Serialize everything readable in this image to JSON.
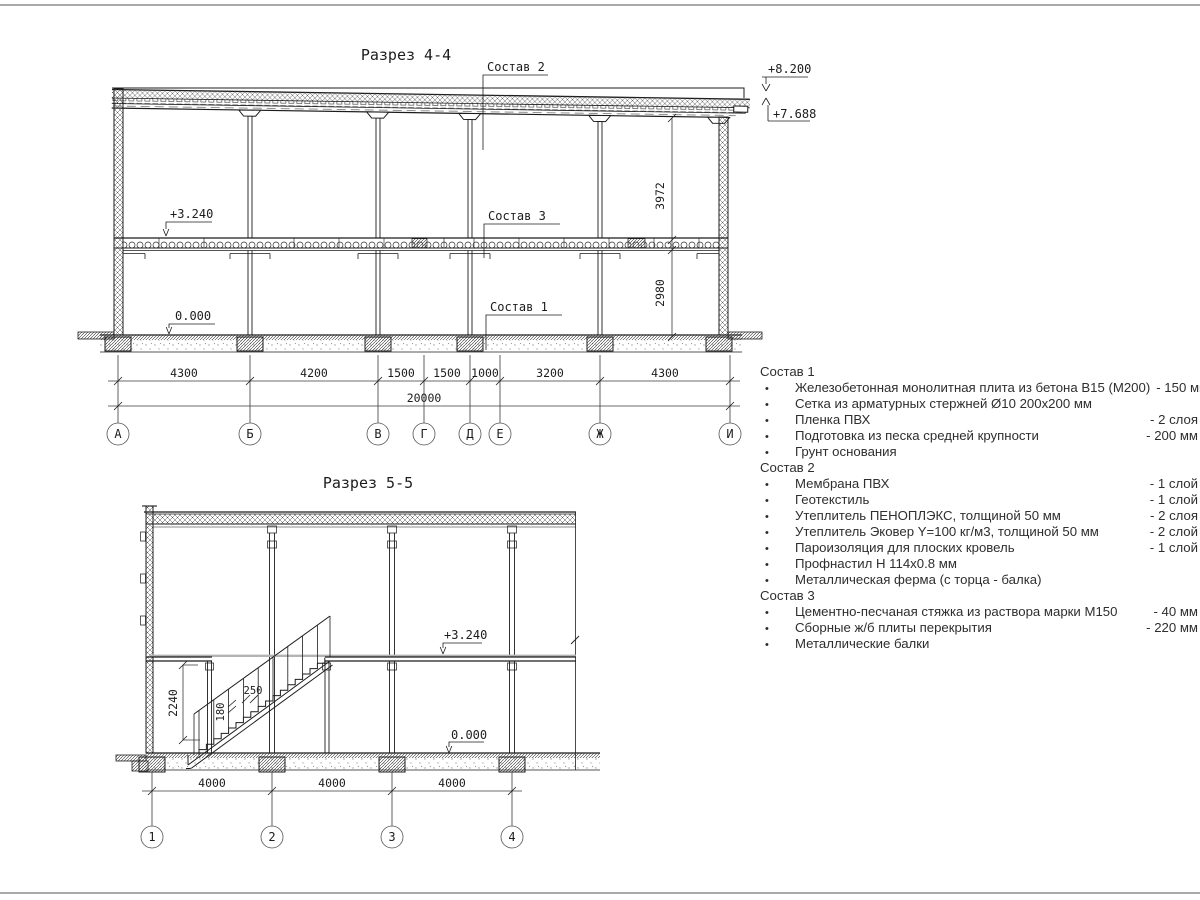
{
  "colors": {
    "ink": "#1c1c1c",
    "gray_line": "#a9a9a9",
    "soft_gray": "#8f8f8f",
    "text": "#2e2e2e"
  },
  "section44": {
    "title": "Разрез 4-4",
    "callouts": {
      "c1": "Состав 1",
      "c2": "Состав 2",
      "c3": "Состав 3"
    },
    "levels": {
      "parapet": "+8.200",
      "roof_edge": "+7.688",
      "floor": "+3.240",
      "ground": "0.000"
    },
    "dims": {
      "floor2_height": "3972",
      "floor1_height": "2980",
      "spans": [
        "4300",
        "4200",
        "1500",
        "1500",
        "1000",
        "3200",
        "4300"
      ],
      "total": "20000"
    },
    "axes": [
      "А",
      "Б",
      "В",
      "Г",
      "Д",
      "Е",
      "Ж",
      "И"
    ]
  },
  "section55": {
    "title": "Разрез 5-5",
    "levels": {
      "floor": "+3.240",
      "ground": "0.000"
    },
    "dims": {
      "rail_height": "2240",
      "tread": "250",
      "riser": "180",
      "spans": [
        "4000",
        "4000",
        "4000"
      ]
    },
    "axes": [
      "1",
      "2",
      "3",
      "4"
    ]
  },
  "compositions": [
    {
      "title": "Состав 1",
      "items": [
        {
          "text": "Железобетонная монолитная плита из бетона В15 (М200)",
          "value": "- 150 мм"
        },
        {
          "text": "Сетка из арматурных стержней Ø10 200х200 мм",
          "value": ""
        },
        {
          "text": "Пленка ПВХ",
          "value": "- 2 слоя"
        },
        {
          "text": "Подготовка из песка средней крупности",
          "value": "- 200 мм"
        },
        {
          "text": "Грунт основания",
          "value": ""
        }
      ]
    },
    {
      "title": "Состав 2",
      "items": [
        {
          "text": "Мембрана ПВХ",
          "value": "- 1 слой"
        },
        {
          "text": "Геотекстиль",
          "value": "- 1 слой"
        },
        {
          "text": "Утеплитель ПЕНОПЛЭКС, толщиной 50 мм",
          "value": "- 2 слоя"
        },
        {
          "text": "Утеплитель Эковер Y=100 кг/м3, толщиной 50 мм",
          "value": "- 2 слой"
        },
        {
          "text": "Пароизоляция для плоских кровель",
          "value": "- 1 слой"
        },
        {
          "text": "Профнастил Н 114х0.8 мм",
          "value": ""
        },
        {
          "text": "Металлическая ферма (с торца - балка)",
          "value": ""
        }
      ]
    },
    {
      "title": "Состав 3",
      "items": [
        {
          "text": "Цементно-песчаная стяжка из раствора марки М150",
          "value": "- 40 мм"
        },
        {
          "text": "Сборные ж/б плиты перекрытия",
          "value": "- 220 мм"
        },
        {
          "text": "Металлические балки",
          "value": ""
        }
      ]
    }
  ]
}
